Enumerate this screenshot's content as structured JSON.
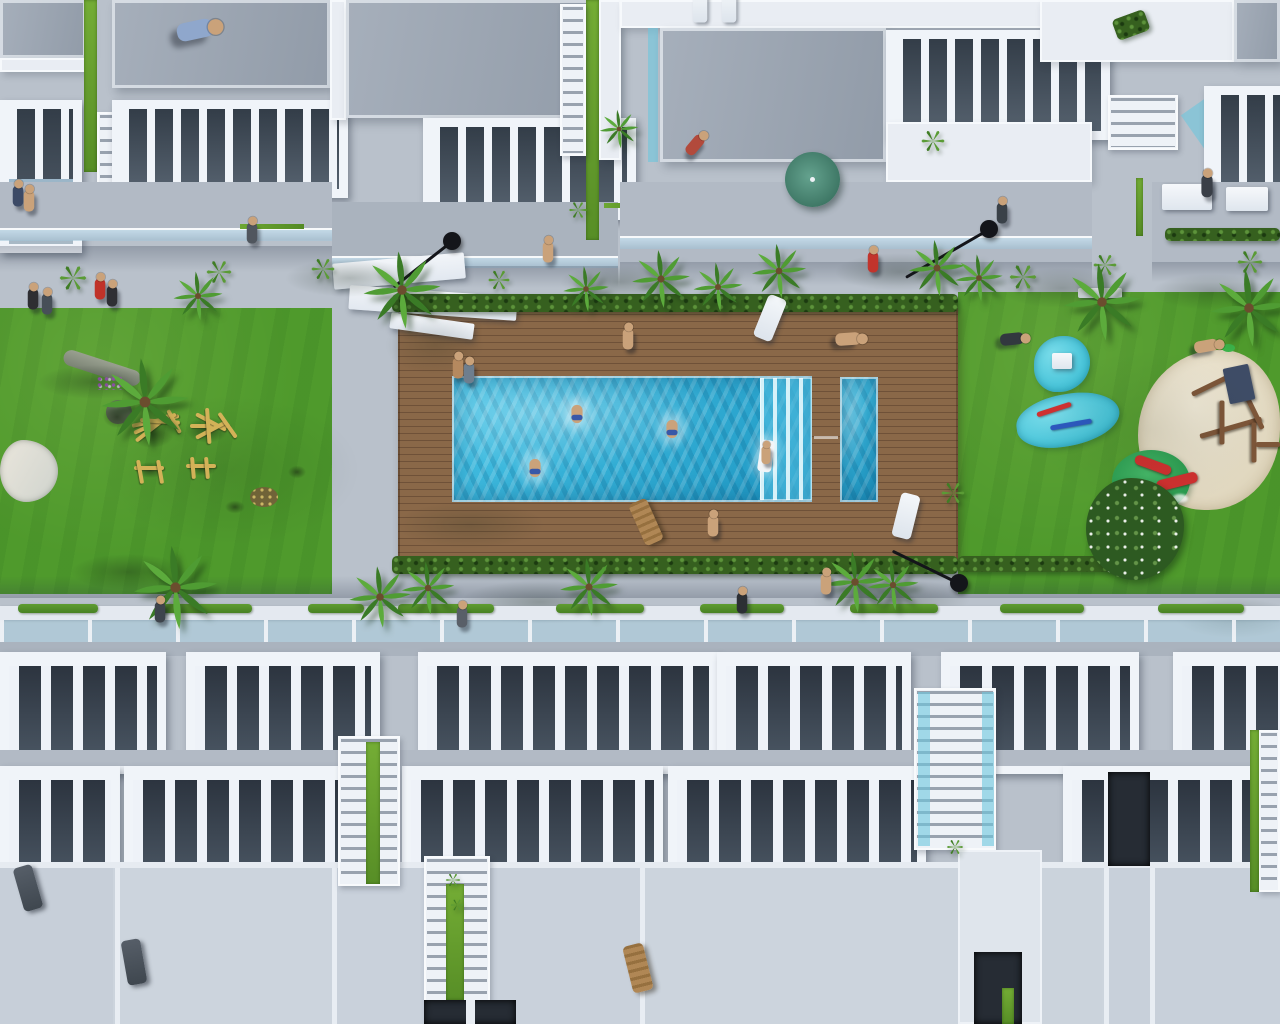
{
  "scene": {
    "alt": "Aerial 3D architectural rendering of a white townhouse residential complex with a communal swimming pool, kids splash pool, wooden sun deck, lawns, playgrounds, sand play area with red slide, palm trees and tiny people",
    "colors": {
      "paving": "#b9c1cb",
      "white": "#eff3f8",
      "roof_gray": "#9ba5b1",
      "lawn": "#4f9a2c",
      "lawn_dark": "#3b7a1f",
      "deck": "#8a6848",
      "deck_gap": "#6f5138",
      "pool": "#2fb4da",
      "pool_deep": "#1d96c2",
      "splash": "#3ec1d6",
      "blob": "#3fc0d6",
      "hedge": "#36601f",
      "palm": "#4f9c33",
      "palm_dark": "#3a7b26",
      "sand": "#ddd3b9",
      "slide": "#d03030",
      "mound": "#27984d",
      "wood": "#d3b258",
      "wood_dark": "#7d5639",
      "navy": "#3e4c66",
      "umbrella": "#3e7765",
      "lamp": "#14151a",
      "glass": "#a8cfe0",
      "skin": "#caa27a"
    },
    "counts": {
      "lamps": 3,
      "palms": 18,
      "people": 25,
      "swimmers": 3,
      "pools": 2
    }
  },
  "palms": [
    {
      "x": 95,
      "y": 352,
      "s": 100
    },
    {
      "x": 170,
      "y": 268,
      "s": 56
    },
    {
      "x": 358,
      "y": 246,
      "s": 88
    },
    {
      "x": 128,
      "y": 540,
      "s": 95
    },
    {
      "x": 345,
      "y": 562,
      "s": 70
    },
    {
      "x": 560,
      "y": 263,
      "s": 52
    },
    {
      "x": 597,
      "y": 107,
      "s": 44
    },
    {
      "x": 628,
      "y": 246,
      "s": 66
    },
    {
      "x": 690,
      "y": 259,
      "s": 56
    },
    {
      "x": 748,
      "y": 240,
      "s": 62
    },
    {
      "x": 905,
      "y": 236,
      "s": 64
    },
    {
      "x": 952,
      "y": 251,
      "s": 54
    },
    {
      "x": 1058,
      "y": 258,
      "s": 88
    },
    {
      "x": 1205,
      "y": 264,
      "s": 88
    },
    {
      "x": 398,
      "y": 558,
      "s": 60
    },
    {
      "x": 556,
      "y": 554,
      "s": 66
    },
    {
      "x": 820,
      "y": 547,
      "s": 70
    },
    {
      "x": 864,
      "y": 556,
      "s": 58
    }
  ],
  "tufts": [
    {
      "x": 58,
      "y": 263,
      "s": 30
    },
    {
      "x": 205,
      "y": 258,
      "s": 28
    },
    {
      "x": 310,
      "y": 256,
      "s": 26
    },
    {
      "x": 487,
      "y": 268,
      "s": 24
    },
    {
      "x": 1008,
      "y": 262,
      "s": 30
    },
    {
      "x": 1092,
      "y": 252,
      "s": 26
    },
    {
      "x": 1236,
      "y": 248,
      "s": 28
    },
    {
      "x": 940,
      "y": 480,
      "s": 26
    },
    {
      "x": 445,
      "y": 872,
      "s": 16
    },
    {
      "x": 450,
      "y": 898,
      "s": 14
    },
    {
      "x": 946,
      "y": 838,
      "s": 18
    },
    {
      "x": 920,
      "y": 128,
      "s": 26
    },
    {
      "x": 568,
      "y": 200,
      "s": 20
    }
  ],
  "lamps": [
    {
      "x": 452,
      "y": 241,
      "len": 74,
      "ang": 142
    },
    {
      "x": 989,
      "y": 229,
      "len": 96,
      "ang": 150
    },
    {
      "x": 959,
      "y": 583,
      "len": 74,
      "ang": 206
    }
  ],
  "people": [
    {
      "x": 195,
      "y": 30,
      "c": "#8fa7cc",
      "r": 78,
      "s": 2.6
    },
    {
      "x": 18,
      "y": 196,
      "c": "#3c4a66"
    },
    {
      "x": 29,
      "y": 201,
      "c": "#caa27a"
    },
    {
      "x": 33,
      "y": 299,
      "c": "#2e2e32"
    },
    {
      "x": 47,
      "y": 304,
      "c": "#474f58"
    },
    {
      "x": 100,
      "y": 289,
      "c": "#c03229"
    },
    {
      "x": 112,
      "y": 296,
      "c": "#2f2f34"
    },
    {
      "x": 252,
      "y": 233,
      "c": "#50565e"
    },
    {
      "x": 548,
      "y": 252,
      "c": "#caa27a"
    },
    {
      "x": 873,
      "y": 262,
      "c": "#c2342c"
    },
    {
      "x": 1002,
      "y": 213,
      "c": "#3a4148"
    },
    {
      "x": 1207,
      "y": 186,
      "c": "#3a3f47",
      "s": 1.6
    },
    {
      "x": 628,
      "y": 339,
      "c": "#caa27a"
    },
    {
      "x": 458,
      "y": 368,
      "c": "#b5895f"
    },
    {
      "x": 469,
      "y": 373,
      "c": "#6e7e8e"
    },
    {
      "x": 713,
      "y": 526,
      "c": "#caa27a"
    },
    {
      "x": 848,
      "y": 339,
      "c": "#caa27a",
      "r": 86,
      "s": 1.8
    },
    {
      "x": 1012,
      "y": 339,
      "c": "#32383f",
      "r": 84,
      "s": 1.7
    },
    {
      "x": 1206,
      "y": 346,
      "c": "#caa27a",
      "r": 80,
      "s": 1.7
    },
    {
      "x": 742,
      "y": 603,
      "c": "#2c2f34"
    },
    {
      "x": 826,
      "y": 584,
      "c": "#caa27a"
    },
    {
      "x": 462,
      "y": 617,
      "c": "#595f68"
    },
    {
      "x": 160,
      "y": 612,
      "c": "#3e444c"
    },
    {
      "x": 695,
      "y": 145,
      "c": "#b24a3c",
      "r": 40,
      "s": 1.6
    },
    {
      "x": 766,
      "y": 455,
      "c": "#caa27a",
      "s": 1.3
    }
  ],
  "swimmers": [
    {
      "x": 577,
      "y": 414
    },
    {
      "x": 672,
      "y": 429
    },
    {
      "x": 535,
      "y": 468
    }
  ],
  "loungers_white": [
    {
      "x": 700,
      "y": 6,
      "r": 0,
      "s": 1.1
    },
    {
      "x": 729,
      "y": 6,
      "r": 0,
      "s": 1.1
    },
    {
      "x": 770,
      "y": 318,
      "r": 22,
      "s": 1.5
    },
    {
      "x": 906,
      "y": 516,
      "r": 14,
      "s": 1.5
    }
  ],
  "loungers_wood": [
    {
      "x": 646,
      "y": 522,
      "r": -24,
      "s": 1.5
    },
    {
      "x": 638,
      "y": 968,
      "r": -14,
      "s": 1.6
    }
  ],
  "loungers_dark": [
    {
      "x": 28,
      "y": 888,
      "r": -16,
      "s": 1.5
    },
    {
      "x": 134,
      "y": 962,
      "r": -10,
      "s": 1.5
    }
  ],
  "shadows": [
    {
      "x": 350,
      "y": 278,
      "w": 130,
      "h": 38,
      "o": 0.3
    },
    {
      "x": 620,
      "y": 282,
      "w": 120,
      "h": 34,
      "o": 0.28
    },
    {
      "x": 900,
      "y": 272,
      "w": 130,
      "h": 38,
      "o": 0.28
    },
    {
      "x": 1062,
      "y": 288,
      "w": 130,
      "h": 40,
      "o": 0.3
    },
    {
      "x": 1212,
      "y": 292,
      "w": 120,
      "h": 36,
      "o": 0.28
    },
    {
      "x": 540,
      "y": 602,
      "w": 160,
      "h": 44,
      "o": 0.3
    },
    {
      "x": 890,
      "y": 600,
      "w": 160,
      "h": 44,
      "o": 0.28
    },
    {
      "x": 1235,
      "y": 618,
      "w": 120,
      "h": 40,
      "o": 0.26
    },
    {
      "x": 95,
      "y": 382,
      "w": 115,
      "h": 34,
      "o": 0.38
    },
    {
      "x": 128,
      "y": 572,
      "w": 115,
      "h": 36,
      "o": 0.38
    },
    {
      "x": 230,
      "y": 470,
      "w": 260,
      "h": 150,
      "o": 0.14
    },
    {
      "x": 435,
      "y": 345,
      "w": 100,
      "h": 60,
      "o": 0.18
    },
    {
      "x": 470,
      "y": 525,
      "w": 150,
      "h": 48,
      "o": 0.2
    },
    {
      "x": 1150,
      "y": 430,
      "w": 230,
      "h": 160,
      "o": 0.1
    }
  ],
  "eqshadows": [
    {
      "x": 152,
      "y": 434,
      "w": 44,
      "h": 28
    },
    {
      "x": 207,
      "y": 430,
      "w": 42,
      "h": 26
    },
    {
      "x": 150,
      "y": 470,
      "w": 30,
      "h": 16
    },
    {
      "x": 202,
      "y": 468,
      "w": 30,
      "h": 16
    },
    {
      "x": 117,
      "y": 417,
      "w": 28,
      "h": 22
    },
    {
      "x": 297,
      "y": 472,
      "w": 18,
      "h": 13
    },
    {
      "x": 235,
      "y": 507,
      "w": 20,
      "h": 13
    }
  ],
  "dashes": [
    {
      "x": 18,
      "y": 604,
      "w": 80
    },
    {
      "x": 160,
      "y": 604,
      "w": 92
    },
    {
      "x": 308,
      "y": 604,
      "w": 56
    },
    {
      "x": 398,
      "y": 604,
      "w": 96
    },
    {
      "x": 556,
      "y": 604,
      "w": 88
    },
    {
      "x": 700,
      "y": 604,
      "w": 84
    },
    {
      "x": 850,
      "y": 604,
      "w": 88
    },
    {
      "x": 1000,
      "y": 604,
      "w": 84
    },
    {
      "x": 1158,
      "y": 604,
      "w": 86
    }
  ],
  "wood_bars": [
    {
      "x": 132,
      "y": 424,
      "w": 48,
      "r": -12
    },
    {
      "x": 134,
      "y": 431,
      "w": 46,
      "r": -24
    },
    {
      "x": 136,
      "y": 439,
      "w": 42,
      "r": -38
    },
    {
      "x": 140,
      "y": 418,
      "w": 40,
      "r": 4
    },
    {
      "x": 168,
      "y": 408,
      "w": 26,
      "r": 62
    },
    {
      "x": 190,
      "y": 424,
      "w": 40,
      "r": 0
    },
    {
      "x": 196,
      "y": 412,
      "w": 34,
      "r": 28
    },
    {
      "x": 196,
      "y": 436,
      "w": 34,
      "r": -28
    },
    {
      "x": 207,
      "y": 406,
      "w": 36,
      "r": 86
    },
    {
      "x": 219,
      "y": 411,
      "w": 30,
      "r": 55
    },
    {
      "x": 134,
      "y": 466,
      "w": 30,
      "r": 0
    },
    {
      "x": 138,
      "y": 458,
      "w": 24,
      "r": 80
    },
    {
      "x": 158,
      "y": 458,
      "w": 24,
      "r": 80
    },
    {
      "x": 186,
      "y": 464,
      "w": 30,
      "r": 0
    },
    {
      "x": 192,
      "y": 455,
      "w": 22,
      "r": 85
    },
    {
      "x": 206,
      "y": 455,
      "w": 22,
      "r": 85
    }
  ]
}
